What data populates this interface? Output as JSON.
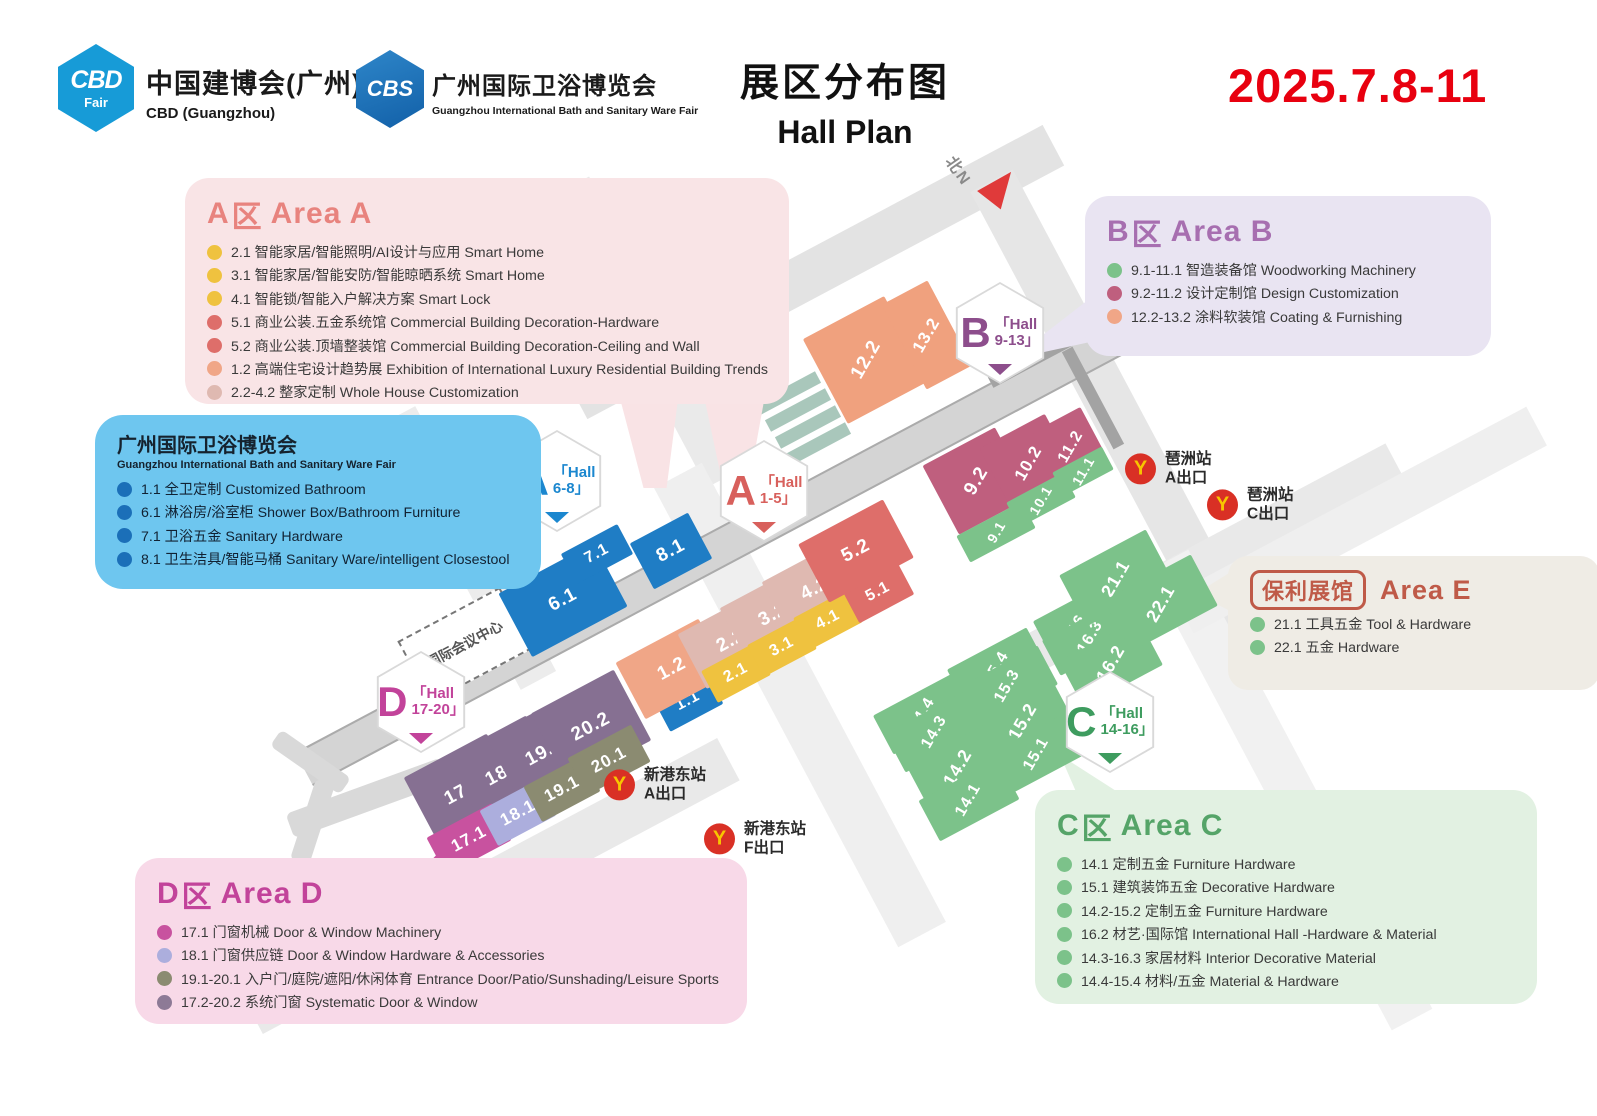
{
  "header": {
    "cbd_logo_text": "CBD",
    "cbd_logo_sub": "Fair",
    "cbd_title": "中国建博会(广州)",
    "cbd_subtitle": "CBD (Guangzhou)",
    "cbs_logo_text": "CBS",
    "cbs_title": "广州国际卫浴博览会",
    "cbs_subtitle": "Guangzhou International Bath and Sanitary Ware Fair",
    "title_cn": "展区分布图",
    "title_en": "Hall Plan",
    "date": "2025.7.8-11"
  },
  "legends": {
    "area_a": {
      "letter": "A",
      "qu": "区",
      "name": "Area A",
      "color": "#E8837E",
      "items": [
        {
          "dot": "#EFC23F",
          "text": "2.1 智能家居/智能照明/AI设计与应用 Smart Home"
        },
        {
          "dot": "#EFC23F",
          "text": "3.1 智能家居/智能安防/智能晾晒系统 Smart Home"
        },
        {
          "dot": "#EFC23F",
          "text": "4.1 智能锁/智能入户解决方案 Smart Lock"
        },
        {
          "dot": "#DE6E6A",
          "text": "5.1 商业公装.五金系统馆 Commercial Building Decoration-Hardware"
        },
        {
          "dot": "#DE6E6A",
          "text": "5.2 商业公装.顶墙整装馆 Commercial Building Decoration-Ceiling and Wall"
        },
        {
          "dot": "#F0A687",
          "text": "1.2 高端住宅设计趋势展 Exhibition of International Luxury Residential Building Trends"
        },
        {
          "dot": "#DFB9B1",
          "text": "2.2-4.2 整家定制 Whole House Customization"
        }
      ]
    },
    "area_b": {
      "letter": "B",
      "qu": "区",
      "name": "Area B",
      "color": "#A76FB0",
      "items": [
        {
          "dot": "#7CC28A",
          "text": "9.1-11.1 智造装备馆 Woodworking Machinery"
        },
        {
          "dot": "#BF5F7E",
          "text": "9.2-11.2 设计定制馆 Design Customization"
        },
        {
          "dot": "#F0A687",
          "text": "12.2-13.2 涂料软装馆 Coating & Furnishing"
        }
      ]
    },
    "bath": {
      "title": "广州国际卫浴博览会",
      "subtitle": "Guangzhou International Bath and Sanitary Ware Fair",
      "items": [
        {
          "dot": "#1B6FB8",
          "text": "1.1 全卫定制 Customized Bathroom"
        },
        {
          "dot": "#1B6FB8",
          "text": "6.1 淋浴房/浴室柜 Shower Box/Bathroom Furniture"
        },
        {
          "dot": "#1B6FB8",
          "text": "7.1 卫浴五金 Sanitary Hardware"
        },
        {
          "dot": "#1B6FB8",
          "text": "8.1 卫生洁具/智能马桶 Sanitary Ware/intelligent Closestool"
        }
      ]
    },
    "area_e": {
      "boxed": "保利展馆",
      "name": "Area E",
      "color": "#BF5A48",
      "items": [
        {
          "dot": "#7CC28A",
          "text": "21.1 工具五金 Tool & Hardware"
        },
        {
          "dot": "#7CC28A",
          "text": "22.1 五金 Hardware"
        }
      ]
    },
    "area_c": {
      "letter": "C",
      "qu": "区",
      "name": "Area C",
      "color": "#55A468",
      "items": [
        {
          "dot": "#7CC28A",
          "text": "14.1 定制五金 Furniture Hardware"
        },
        {
          "dot": "#7CC28A",
          "text": "15.1 建筑装饰五金 Decorative Hardware"
        },
        {
          "dot": "#7CC28A",
          "text": "14.2-15.2 定制五金 Furniture Hardware"
        },
        {
          "dot": "#7CC28A",
          "text": "16.2 材艺·国际馆 International Hall -Hardware & Material"
        },
        {
          "dot": "#7CC28A",
          "text": "14.3-16.3 家居材料 Interior Decorative Material"
        },
        {
          "dot": "#7CC28A",
          "text": "14.4-15.4 材料/五金 Material & Hardware"
        }
      ]
    },
    "area_d": {
      "letter": "D",
      "qu": "区",
      "name": "Area D",
      "color": "#C2439A",
      "items": [
        {
          "dot": "#C8529F",
          "text": "17.1 门窗机械  Door & Window Machinery"
        },
        {
          "dot": "#ACAEDD",
          "text": "18.1 门窗供应链  Door & Window Hardware & Accessories"
        },
        {
          "dot": "#8B8B71",
          "text": "19.1-20.1 入户门/庭院/遮阳/休闲体育 Entrance Door/Patio/Sunshading/Leisure Sports"
        },
        {
          "dot": "#8D7A96",
          "text": "17.2-20.2 系统门窗 Systematic Door & Window"
        }
      ]
    }
  },
  "map": {
    "north_label": "北N",
    "landmark": "国际会议中心",
    "roads": [
      {
        "x": 815,
        "y": 272,
        "w": 540,
        "h": 46,
        "rot": -28,
        "c": "#E3E3E3"
      },
      {
        "x": 1123,
        "y": 428,
        "w": 560,
        "h": 48,
        "rot": 62,
        "c": "#E6E6E6"
      },
      {
        "x": 648,
        "y": 332,
        "w": 330,
        "h": 42,
        "rot": 62,
        "c": "#EAEAEA"
      },
      {
        "x": 468,
        "y": 548,
        "w": 300,
        "h": 40,
        "rot": 62,
        "c": "#ECECEC"
      },
      {
        "x": 800,
        "y": 705,
        "w": 520,
        "h": 54,
        "rot": 62,
        "c": "#EFEFEF"
      },
      {
        "x": 490,
        "y": 886,
        "w": 540,
        "h": 48,
        "rot": -28,
        "c": "#E9E9E9"
      },
      {
        "x": 1205,
        "y": 562,
        "w": 430,
        "h": 40,
        "rot": -28,
        "c": "#E9E9E9"
      },
      {
        "x": 1290,
        "y": 790,
        "w": 520,
        "h": 46,
        "rot": 62,
        "c": "#F1F1F1"
      },
      {
        "x": 1360,
        "y": 520,
        "w": 400,
        "h": 44,
        "rot": -28,
        "c": "#EFEFEF"
      },
      {
        "x": 750,
        "y": 532,
        "w": 1010,
        "h": 34,
        "rot": -28,
        "c": "#D4D4D4",
        "edge": true
      },
      {
        "x": 1048,
        "y": 352,
        "w": 130,
        "h": 12,
        "rot": -28,
        "c": "#A3A3A3"
      },
      {
        "x": 1093,
        "y": 398,
        "w": 110,
        "h": 12,
        "rot": 62,
        "c": "#A3A3A3"
      }
    ],
    "strips": [
      {
        "x": 788,
        "y": 393
      },
      {
        "x": 798,
        "y": 410
      },
      {
        "x": 808,
        "y": 427
      },
      {
        "x": 818,
        "y": 444
      }
    ],
    "halls": [
      {
        "id": "6.1",
        "x": 563,
        "y": 600,
        "w": 108,
        "h": 72,
        "color": "#1F7DC5",
        "fs": 19
      },
      {
        "id": "7.1",
        "x": 597,
        "y": 554,
        "w": 64,
        "h": 34,
        "color": "#1F7DC5",
        "fs": 16
      },
      {
        "id": "8.1",
        "x": 671,
        "y": 551,
        "w": 66,
        "h": 52,
        "color": "#1F7DC5",
        "fs": 19
      },
      {
        "id": "1.1",
        "x": 688,
        "y": 701,
        "w": 60,
        "h": 38,
        "color": "#1F7DC5",
        "fs": 16
      },
      {
        "id": "1.2",
        "x": 672,
        "y": 669,
        "w": 94,
        "h": 64,
        "color": "#F0A687",
        "fs": 19
      },
      {
        "id": "2.2",
        "x": 731,
        "y": 641,
        "w": 88,
        "h": 62,
        "color": "#DFB9B1",
        "fs": 19
      },
      {
        "id": "3.2",
        "x": 773,
        "y": 615,
        "w": 88,
        "h": 62,
        "color": "#DFB9B1",
        "fs": 19
      },
      {
        "id": "4.2",
        "x": 815,
        "y": 589,
        "w": 88,
        "h": 62,
        "color": "#DFB9B1",
        "fs": 19
      },
      {
        "id": "2.1",
        "x": 736,
        "y": 673,
        "w": 60,
        "h": 36,
        "color": "#EFC23F",
        "fs": 16
      },
      {
        "id": "3.1",
        "x": 782,
        "y": 647,
        "w": 60,
        "h": 36,
        "color": "#EFC23F",
        "fs": 16
      },
      {
        "id": "4.1",
        "x": 828,
        "y": 620,
        "w": 60,
        "h": 36,
        "color": "#EFC23F",
        "fs": 16
      },
      {
        "id": "5.1",
        "x": 878,
        "y": 592,
        "w": 62,
        "h": 38,
        "color": "#DE6E6A",
        "fs": 16
      },
      {
        "id": "5.2",
        "x": 856,
        "y": 551,
        "w": 96,
        "h": 66,
        "color": "#DE6E6A",
        "fs": 19
      },
      {
        "id": "12.2",
        "x": 866,
        "y": 360,
        "w": 92,
        "h": 96,
        "color": "#F0A17E",
        "fs": 19,
        "steep": true
      },
      {
        "id": "13.2",
        "x": 927,
        "y": 335,
        "w": 52,
        "h": 96,
        "color": "#F0A17E",
        "fs": 17,
        "steep": true
      },
      {
        "id": "9.2",
        "x": 977,
        "y": 481,
        "w": 82,
        "h": 78,
        "color": "#BF5F7E",
        "fs": 19,
        "steep": true
      },
      {
        "id": "10.2",
        "x": 1029,
        "y": 463,
        "w": 74,
        "h": 72,
        "color": "#BF5F7E",
        "fs": 17,
        "steep": true
      },
      {
        "id": "11.2",
        "x": 1071,
        "y": 447,
        "w": 54,
        "h": 62,
        "color": "#BF5F7E",
        "fs": 16,
        "steep": true
      },
      {
        "id": "9.1",
        "x": 996,
        "y": 532,
        "w": 74,
        "h": 30,
        "color": "#7CC28A",
        "fs": 14,
        "steep": true
      },
      {
        "id": "10.1",
        "x": 1041,
        "y": 500,
        "w": 64,
        "h": 28,
        "color": "#7CC28A",
        "fs": 14,
        "steep": true
      },
      {
        "id": "11.1",
        "x": 1083,
        "y": 471,
        "w": 56,
        "h": 26,
        "color": "#7CC28A",
        "fs": 14,
        "steep": true
      },
      {
        "id": "16.4",
        "x": 1082,
        "y": 618,
        "w": 90,
        "h": 40,
        "color": "#7CC28A",
        "fs": 16,
        "steep": true
      },
      {
        "id": "16.3",
        "x": 1091,
        "y": 637,
        "w": 90,
        "h": 40,
        "color": "#7CC28A",
        "fs": 16,
        "steep": true
      },
      {
        "id": "16.2",
        "x": 1111,
        "y": 663,
        "w": 90,
        "h": 52,
        "color": "#7CC28A",
        "fs": 18,
        "steep": true
      },
      {
        "id": "15.4",
        "x": 997,
        "y": 668,
        "w": 90,
        "h": 44,
        "color": "#7CC28A",
        "fs": 16,
        "steep": true
      },
      {
        "id": "15.3",
        "x": 1008,
        "y": 686,
        "w": 90,
        "h": 44,
        "color": "#7CC28A",
        "fs": 16,
        "steep": true
      },
      {
        "id": "15.2",
        "x": 1023,
        "y": 721,
        "w": 90,
        "h": 52,
        "color": "#7CC28A",
        "fs": 18,
        "steep": true
      },
      {
        "id": "15.1",
        "x": 1037,
        "y": 754,
        "w": 90,
        "h": 46,
        "color": "#7CC28A",
        "fs": 16,
        "steep": true
      },
      {
        "id": "14.4",
        "x": 923,
        "y": 714,
        "w": 90,
        "h": 44,
        "color": "#7CC28A",
        "fs": 16,
        "steep": true
      },
      {
        "id": "14.3",
        "x": 935,
        "y": 732,
        "w": 90,
        "h": 44,
        "color": "#7CC28A",
        "fs": 16,
        "steep": true
      },
      {
        "id": "14.2",
        "x": 958,
        "y": 767,
        "w": 90,
        "h": 50,
        "color": "#7CC28A",
        "fs": 18,
        "steep": true
      },
      {
        "id": "14.1",
        "x": 969,
        "y": 800,
        "w": 90,
        "h": 46,
        "color": "#7CC28A",
        "fs": 16,
        "steep": true
      },
      {
        "id": "21.1",
        "x": 1116,
        "y": 578,
        "w": 98,
        "h": 58,
        "color": "#7CC28A",
        "fs": 18,
        "steep": true
      },
      {
        "id": "22.1",
        "x": 1161,
        "y": 603,
        "w": 98,
        "h": 58,
        "color": "#7CC28A",
        "fs": 18,
        "steep": true
      },
      {
        "id": "17.2",
        "x": 464,
        "y": 791,
        "w": 94,
        "h": 80,
        "color": "#867092",
        "fs": 19
      },
      {
        "id": "18.2",
        "x": 505,
        "y": 772,
        "w": 90,
        "h": 80,
        "color": "#867092",
        "fs": 19
      },
      {
        "id": "19.2",
        "x": 545,
        "y": 752,
        "w": 90,
        "h": 80,
        "color": "#867092",
        "fs": 19
      },
      {
        "id": "20.2",
        "x": 591,
        "y": 727,
        "w": 94,
        "h": 80,
        "color": "#867092",
        "fs": 19
      },
      {
        "id": "17.1",
        "x": 469,
        "y": 839,
        "w": 74,
        "h": 42,
        "color": "#C8529F",
        "fs": 17
      },
      {
        "id": "18.1",
        "x": 518,
        "y": 813,
        "w": 66,
        "h": 40,
        "color": "#ACAEDD",
        "fs": 17
      },
      {
        "id": "19.1",
        "x": 562,
        "y": 789,
        "w": 66,
        "h": 40,
        "color": "#8B8B71",
        "fs": 17
      },
      {
        "id": "20.1",
        "x": 609,
        "y": 760,
        "w": 72,
        "h": 42,
        "color": "#8B8B71",
        "fs": 17
      }
    ],
    "badges": [
      {
        "letter": "A",
        "l1": "「Hall",
        "l2": "6-8」",
        "color": "#1B87CF",
        "x": 557,
        "y": 481
      },
      {
        "letter": "A",
        "l1": "「Hall",
        "l2": "1-5」",
        "color": "#D8605C",
        "x": 764,
        "y": 491
      },
      {
        "letter": "B",
        "l1": "「Hall",
        "l2": "9-13」",
        "color": "#8D4E8C",
        "x": 1000,
        "y": 333
      },
      {
        "letter": "C",
        "l1": "「Hall",
        "l2": "14-16」",
        "color": "#3E9C5F",
        "x": 1110,
        "y": 722
      },
      {
        "letter": "D",
        "l1": "「Hall",
        "l2": "17-20」",
        "color": "#C2439A",
        "x": 421,
        "y": 702
      }
    ],
    "metros": [
      {
        "station": "琶洲站",
        "exit": "A出口",
        "x": 1125,
        "y": 469
      },
      {
        "station": "琶洲站",
        "exit": "C出口",
        "x": 1207,
        "y": 505
      },
      {
        "station": "新港东站",
        "exit": "A出口",
        "x": 604,
        "y": 785
      },
      {
        "station": "新港东站",
        "exit": "F出口",
        "x": 704,
        "y": 839
      }
    ]
  }
}
